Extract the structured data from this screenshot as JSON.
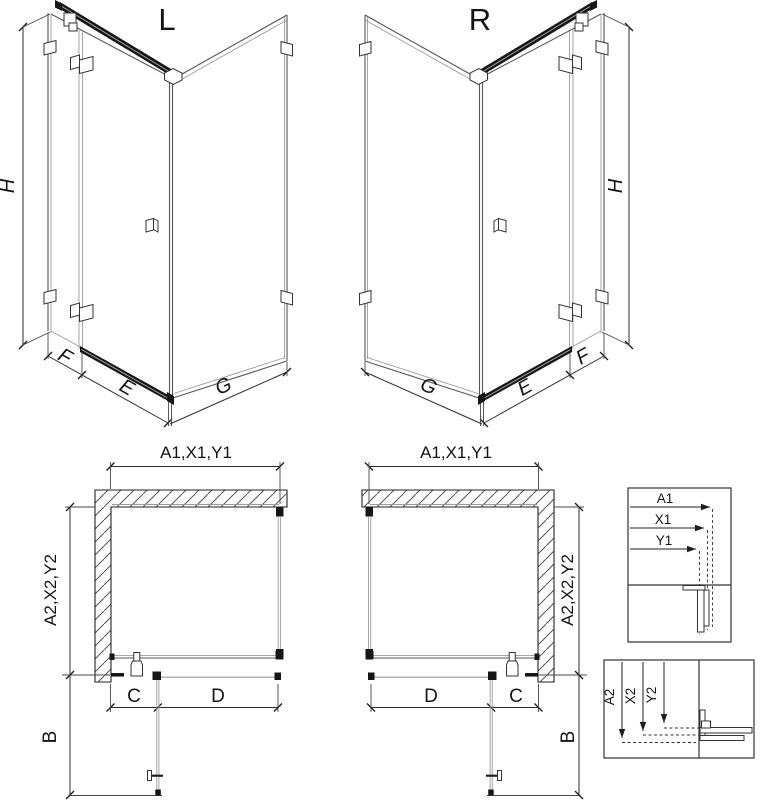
{
  "page": {
    "background": "#ffffff",
    "description": "Technical drawing of a corner shower enclosure in left (L) and right (R) versions: isometric views with H/F/E/G dimensions, plan views with A1/A2 dimension chains, and two measurement detail insets"
  },
  "iso": {
    "left_label": "L",
    "right_label": "R",
    "height_dim": "H",
    "fixed_panel_dim": "F",
    "door_dim": "E",
    "side_panel_dim": "G"
  },
  "plan": {
    "width_dims": "A1,X1,Y1",
    "depth_dims": "A2,X2,Y2",
    "entry_dim": "C",
    "door_width_dim": "D",
    "swing_depth_dim": "B"
  },
  "detail_width": {
    "labels": [
      "A1",
      "X1",
      "Y1"
    ]
  },
  "detail_depth": {
    "labels": [
      "A2",
      "X2",
      "Y2"
    ]
  },
  "colors": {
    "line": "#2e2e2e",
    "glass_edge": "#9a9a9a",
    "profile_dark": "#161616",
    "hatch": "#555555",
    "background": "#ffffff"
  }
}
